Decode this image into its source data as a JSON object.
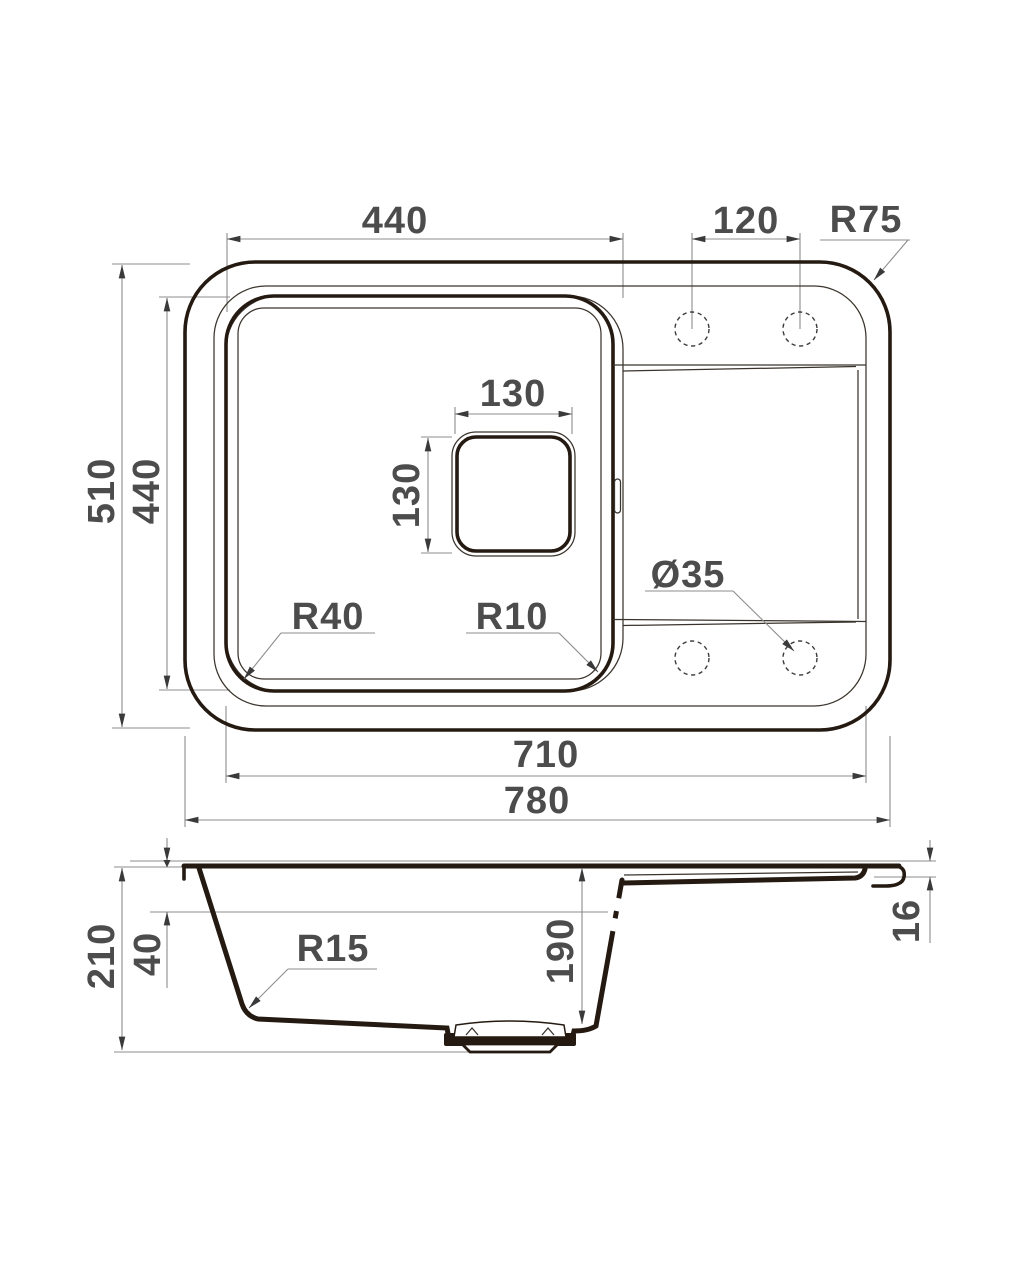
{
  "drawing": {
    "title": "Kitchen sink dimensional drawing, top view and side section",
    "colors": {
      "outline": "#241a11",
      "thin_line": "#3b342d",
      "dimension_line": "#8c8c8c",
      "arrow": "#3a3a3a",
      "text": "#4c4c4c",
      "background": "#ffffff"
    },
    "top_view": {
      "labels": {
        "bowl_width": "440",
        "hole_spacing": "120",
        "outer_corner_radius": "R75",
        "drain_width": "130",
        "drain_height": "130",
        "overall_depth": "510",
        "bowl_depth": "440",
        "bowl_corner_radius": "R40",
        "bowl_inner_radius": "R10",
        "hole_diameter": "Ø35",
        "inner_length": "710",
        "overall_length": "780"
      }
    },
    "side_view": {
      "labels": {
        "overall_height": "210",
        "rim_depth": "40",
        "bowl_inner_depth": "190",
        "bottom_corner_radius": "R15",
        "edge_thickness": "16"
      }
    }
  }
}
